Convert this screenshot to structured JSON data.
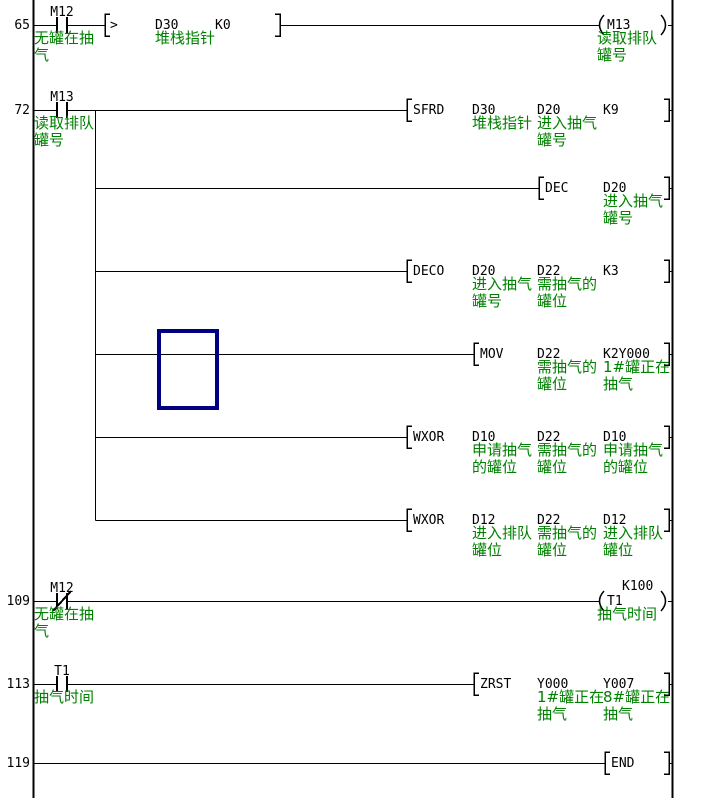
{
  "diagram": {
    "type": "plc-ladder",
    "colors": {
      "background": "#ffffff",
      "wire": "#000000",
      "device_text": "#000000",
      "comment_text": "#008000",
      "selection_box": "#000080"
    },
    "rungs": [
      {
        "step": "65",
        "contact": {
          "device": "M12",
          "type": "NO",
          "comment": [
            "无罐在抽",
            "气"
          ]
        },
        "compare_block": {
          "operator": ">",
          "operands": [
            {
              "name": "D30",
              "comment": [
                "堆栈指针"
              ]
            },
            {
              "name": "K0",
              "comment": []
            }
          ]
        },
        "coil": {
          "device": "M13",
          "comment": [
            "读取排队",
            "罐号"
          ]
        }
      },
      {
        "step": "72",
        "contact": {
          "device": "M13",
          "type": "NO",
          "comment": [
            "读取排队",
            "罐号"
          ]
        },
        "instructions": [
          {
            "opcode": "SFRD",
            "operands": [
              {
                "name": "D30",
                "comment": [
                  "堆栈指针"
                ]
              },
              {
                "name": "D20",
                "comment": [
                  "进入抽气",
                  "罐号"
                ]
              },
              {
                "name": "K9",
                "comment": []
              }
            ]
          },
          {
            "opcode": "DEC",
            "operands": [
              {
                "name": "D20",
                "comment": [
                  "进入抽气",
                  "罐号"
                ]
              }
            ]
          },
          {
            "opcode": "DECO",
            "operands": [
              {
                "name": "D20",
                "comment": [
                  "进入抽气",
                  "罐号"
                ]
              },
              {
                "name": "D22",
                "comment": [
                  "需抽气的",
                  "罐位"
                ]
              },
              {
                "name": "K3",
                "comment": []
              }
            ]
          },
          {
            "opcode": "MOV",
            "selected": true,
            "operands": [
              {
                "name": "D22",
                "comment": [
                  "需抽气的",
                  "罐位"
                ]
              },
              {
                "name": "K2Y000",
                "comment": [
                  "1#罐正在",
                  "抽气"
                ]
              }
            ]
          },
          {
            "opcode": "WXOR",
            "operands": [
              {
                "name": "D10",
                "comment": [
                  "申请抽气",
                  "的罐位"
                ]
              },
              {
                "name": "D22",
                "comment": [
                  "需抽气的",
                  "罐位"
                ]
              },
              {
                "name": "D10",
                "comment": [
                  "申请抽气",
                  "的罐位"
                ]
              }
            ]
          },
          {
            "opcode": "WXOR",
            "operands": [
              {
                "name": "D12",
                "comment": [
                  "进入排队",
                  "罐位"
                ]
              },
              {
                "name": "D22",
                "comment": [
                  "需抽气的",
                  "罐位"
                ]
              },
              {
                "name": "D12",
                "comment": [
                  "进入排队",
                  "罐位"
                ]
              }
            ]
          }
        ]
      },
      {
        "step": "109",
        "contact": {
          "device": "M12",
          "type": "NC",
          "comment": [
            "无罐在抽",
            "气"
          ]
        },
        "coil": {
          "device": "T1",
          "setpoint": "K100",
          "comment": [
            "抽气时间"
          ]
        }
      },
      {
        "step": "113",
        "contact": {
          "device": "T1",
          "type": "NO",
          "comment": [
            "抽气时间"
          ]
        },
        "instructions": [
          {
            "opcode": "ZRST",
            "operands": [
              {
                "name": "Y000",
                "comment": [
                  "1#罐正在",
                  "抽气"
                ]
              },
              {
                "name": "Y007",
                "comment": [
                  "8#罐正在",
                  "抽气"
                ]
              }
            ]
          }
        ]
      },
      {
        "step": "119",
        "instructions": [
          {
            "opcode": "END",
            "operands": []
          }
        ]
      }
    ]
  }
}
